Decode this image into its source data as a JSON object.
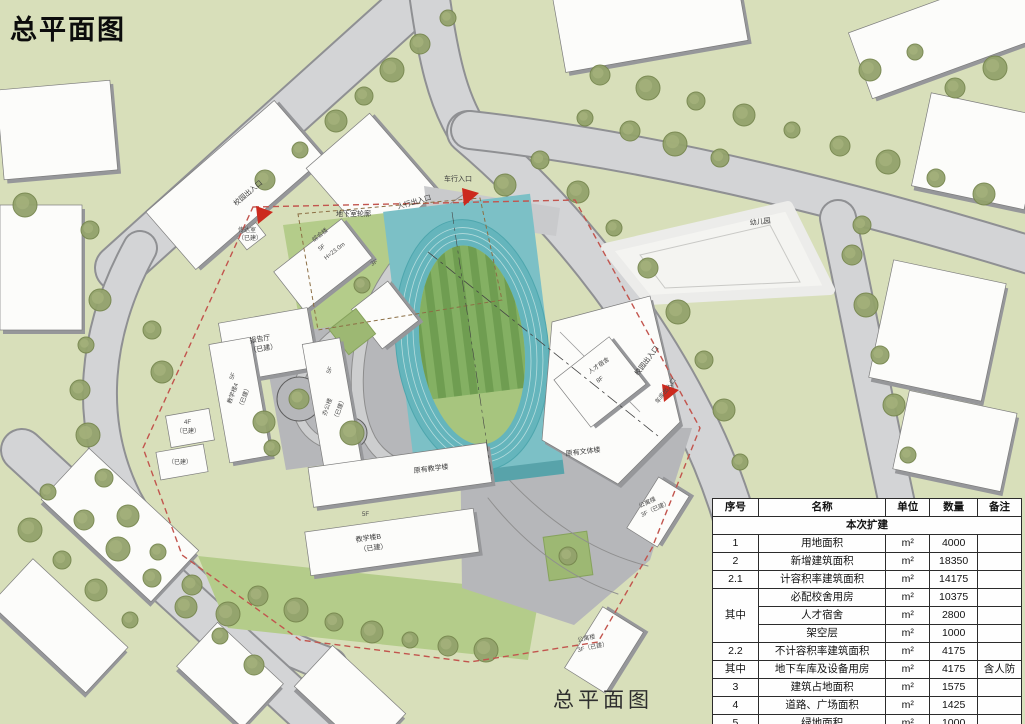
{
  "page": {
    "title": "总平面图",
    "caption": "总平面图"
  },
  "colors": {
    "background_green": "#d8dfba",
    "road_gray": "#d3d4d6",
    "plaza_gray": "#b6b7ba",
    "lawn_green": "#b4cc8a",
    "track_teal": "#7cc0c6",
    "infield_stripe_dark": "#6f9d51",
    "infield_stripe_light": "#84b063",
    "boundary_red": "#c2554e",
    "arrow_red": "#cc2a1e",
    "building_white": "#fcfcfa"
  },
  "plan": {
    "labels": {
      "vehicle_entrance": "车行入口",
      "pedestrian_entrance": "人行出入口",
      "campus_entrance": "校园出入口",
      "garage_entrance": "车库出入口",
      "basement_outline": "地下室轮廓",
      "gatehouse": "传达室",
      "built": "（已建）",
      "complex_name": "综合楼",
      "complex_floors": "5F",
      "complex_height": "H=23.0m",
      "lecture_hall": "报告厅",
      "teaching4": "教学楼4",
      "office": "办公楼",
      "existing_teaching": "原有教学楼",
      "existing_culture": "原有文体楼",
      "talent_dorm": "人才宿舍",
      "talent_floors": "8F",
      "teaching_b": "教学楼B",
      "apartment": "公寓楼",
      "apartment_status": "3F（已建）",
      "kindergarten": "幼儿园",
      "f5": "5F",
      "f4": "4F",
      "f3": "3F"
    }
  },
  "table": {
    "headers": [
      "序号",
      "名称",
      "单位",
      "数量",
      "备注"
    ],
    "section": "本次扩建",
    "rows": [
      {
        "no": "1",
        "name": "用地面积",
        "unit": "m²",
        "qty": "4000",
        "note": ""
      },
      {
        "no": "2",
        "name": "新增建筑面积",
        "unit": "m²",
        "qty": "18350",
        "note": ""
      },
      {
        "no": "2.1",
        "name": "计容积率建筑面积",
        "unit": "m²",
        "qty": "14175",
        "note": ""
      },
      {
        "no": "其中",
        "name": "必配校舍用房",
        "unit": "m²",
        "qty": "10375",
        "note": ""
      },
      {
        "name": "人才宿舍",
        "unit": "m²",
        "qty": "2800",
        "note": ""
      },
      {
        "name": "架空层",
        "unit": "m²",
        "qty": "1000",
        "note": ""
      },
      {
        "no": "2.2",
        "name": "不计容积率建筑面积",
        "unit": "m²",
        "qty": "4175",
        "note": ""
      },
      {
        "no": "其中",
        "name": "地下车库及设备用房",
        "unit": "m²",
        "qty": "4175",
        "note": "含人防"
      },
      {
        "no": "3",
        "name": "建筑占地面积",
        "unit": "m²",
        "qty": "1575",
        "note": ""
      },
      {
        "no": "4",
        "name": "道路、广场面积",
        "unit": "m²",
        "qty": "1425",
        "note": ""
      },
      {
        "no": "5",
        "name": "绿地面积",
        "unit": "m²",
        "qty": "1000",
        "note": ""
      }
    ]
  }
}
